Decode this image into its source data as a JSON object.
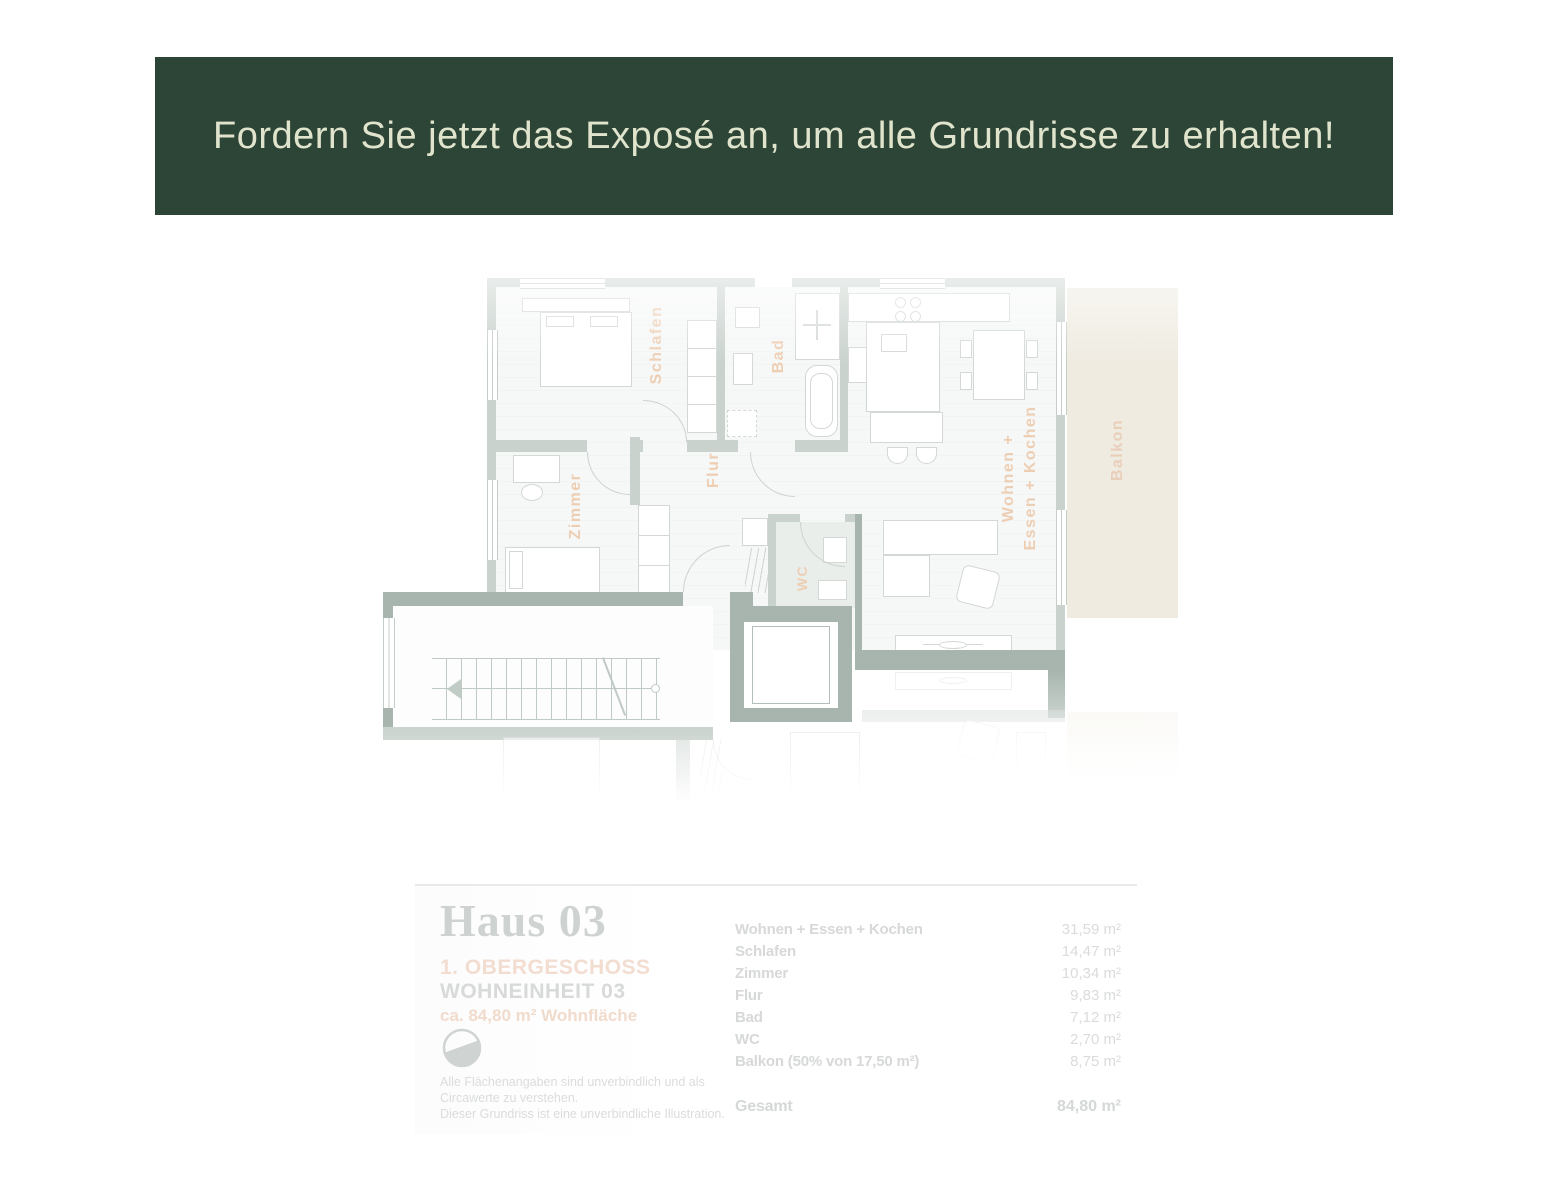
{
  "banner": {
    "text": "Fordern Sie jetzt das Exposé an, um alle Grundrisse zu erhalten!",
    "bg_color": "#2d4536",
    "text_color": "#e1e4cd"
  },
  "plan": {
    "labels": [
      {
        "id": "schlafen",
        "text": "Schlafen"
      },
      {
        "id": "bad",
        "text": "Bad"
      },
      {
        "id": "zimmer",
        "text": "Zimmer"
      },
      {
        "id": "flur",
        "text": "Flur"
      },
      {
        "id": "wc",
        "text": "WC"
      },
      {
        "id": "wohnen-line1",
        "text": "Wohnen +"
      },
      {
        "id": "wohnen-line2",
        "text": "Essen + Kochen"
      },
      {
        "id": "balkon",
        "text": "Balkon"
      }
    ],
    "colors": {
      "wall": "#c9d2cd",
      "wall_dark": "#a7b5ae",
      "room_label": "#eeceb3",
      "balcony_fill": "#efebe1",
      "wc_floor": "#e9eeeb"
    }
  },
  "legend": {
    "title": "Haus 03",
    "floor": "1. OBERGESCHOSS",
    "unit": "WOHNEINHEIT 03",
    "area_label": "ca. 84,80 m² Wohnfläche",
    "disclaimer_lines": [
      "Alle Flächenangaben sind unverbindlich und als",
      "Circawerte zu verstehen.",
      "Dieser Grundriss ist eine unverbindliche Illustration."
    ]
  },
  "area_table": {
    "rows": [
      {
        "label": "Wohnen + Essen + Kochen",
        "value": "31,59 m²"
      },
      {
        "label": "Schlafen",
        "value": "14,47 m²"
      },
      {
        "label": "Zimmer",
        "value": "10,34 m²"
      },
      {
        "label": "Flur",
        "value": "9,83 m²"
      },
      {
        "label": "Bad",
        "value": "7,12 m²"
      },
      {
        "label": "WC",
        "value": "2,70 m²"
      },
      {
        "label": "Balkon (50% von 17,50 m²)",
        "value": "8,75 m²"
      }
    ],
    "total": {
      "label": "Gesamt",
      "value": "84,80 m²"
    }
  }
}
